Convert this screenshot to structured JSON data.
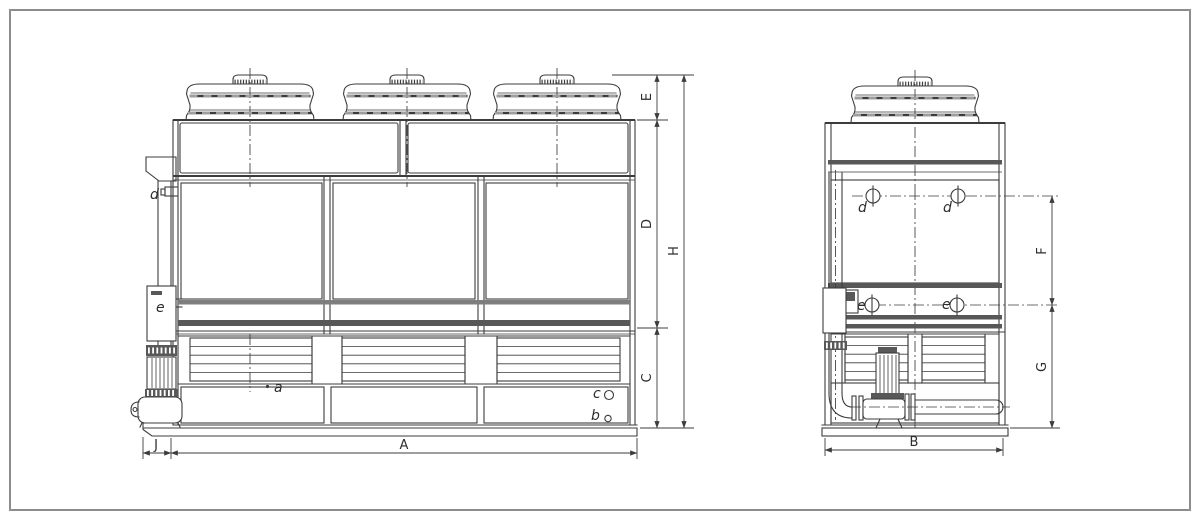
{
  "drawing": {
    "kind": "cooling-tower dimension drawing, front and side elevations",
    "views": [
      {
        "id": "front-view",
        "dimension_labels": [
          "E",
          "D",
          "C",
          "H",
          "A",
          "J"
        ],
        "part_labels": [
          "d",
          "e",
          "a",
          "b",
          "c"
        ]
      },
      {
        "id": "side-view",
        "dimension_labels": [
          "F",
          "G",
          "B"
        ],
        "part_labels": [
          "d",
          "d",
          "e",
          "e"
        ]
      }
    ]
  },
  "labels": {
    "A": "A",
    "B": "B",
    "C": "C",
    "D": "D",
    "E": "E",
    "F": "F",
    "G": "G",
    "H": "H",
    "J": "J",
    "a": "a",
    "b": "b",
    "c": "c",
    "d": "d",
    "e": "e"
  },
  "colors": {
    "background": "#ffffff",
    "border_frame": "#8d8d8d",
    "line": "#3c3c3c",
    "dark_band": "#585858",
    "light_band": "#7e7e7e"
  }
}
